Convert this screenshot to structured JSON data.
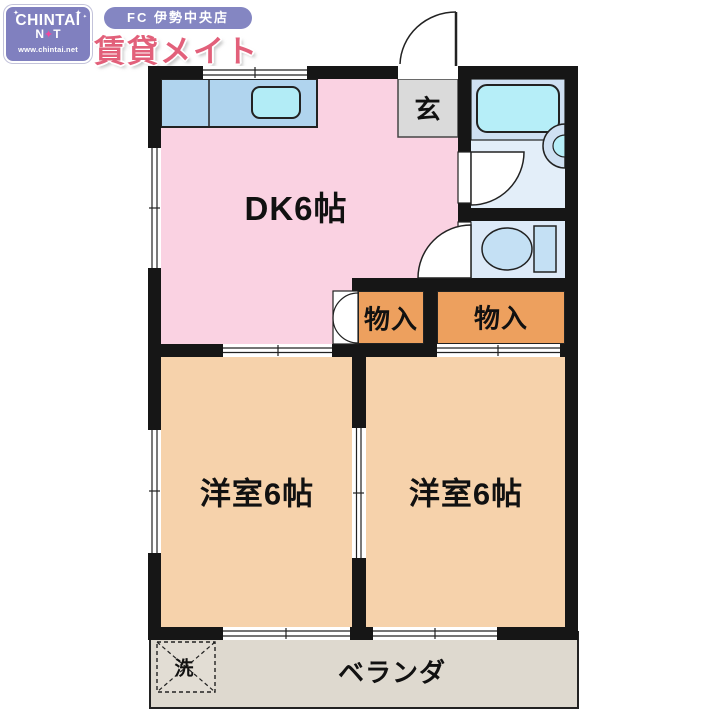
{
  "header": {
    "logo": {
      "line1": "CHINTAI",
      "line2_left": "N",
      "line2_star": "✦",
      "line2_right": "T",
      "url": "www.chintai.net"
    },
    "badge": "FC 伊勢中央店",
    "store": "賃貸メイト"
  },
  "floorplan": {
    "dk": {
      "label": "DK6帖"
    },
    "entrance": {
      "label": "玄"
    },
    "closet_left": {
      "label": "物入"
    },
    "closet_right": {
      "label": "物入"
    },
    "room_left": {
      "label": "洋室6帖"
    },
    "room_right": {
      "label": "洋室6帖"
    },
    "balcony": {
      "label": "ベランダ"
    },
    "laundry": {
      "label": "洗"
    }
  },
  "colors": {
    "wall": "#161616",
    "dk_pink": "#fad2e2",
    "western_room_tan": "#f6d2ab",
    "closet_orange": "#eda05e",
    "kitchen_counter_blue": "#b0d4ee",
    "sink_cyan": "#b2ecf6",
    "entrance_gray": "#dadada",
    "bath_floor": "#e3eef9",
    "bath_upper": "#cfe0f2",
    "bathtub": "#b6eef8",
    "toilet_room": "#ddeaf8",
    "toilet_fixture": "#c4e0f4",
    "balcony_gray": "#ded9cf",
    "logo_purple": "#8080bf",
    "store_pink": "#e2607a"
  }
}
